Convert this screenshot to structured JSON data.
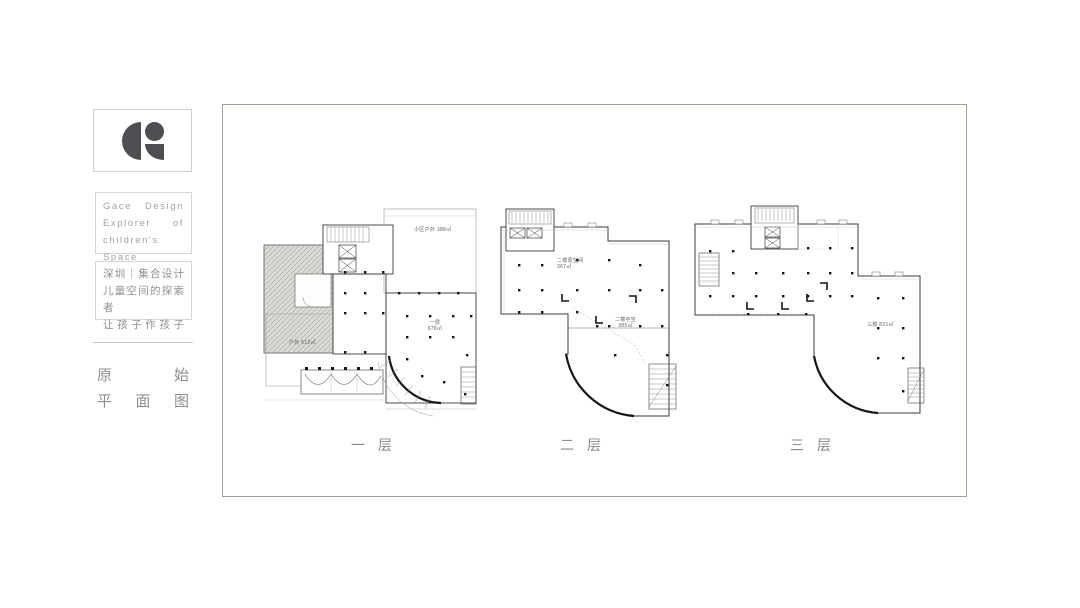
{
  "sidebar": {
    "brand_lines": [
      "Gace Design",
      "Explorer of",
      "children's Space"
    ],
    "tagline_lines": [
      "深圳｜集合设计",
      "儿童空间的探索者",
      "让孩子作孩子"
    ],
    "section_title_lines": [
      "原始",
      "平面图"
    ]
  },
  "board": {
    "plans": [
      {
        "caption": "一层",
        "labels": {
          "outdoor_upper": "小区户外 388㎡",
          "floor_name": "一层",
          "floor_area": "678㎡",
          "terrace": "户外 512㎡"
        }
      },
      {
        "caption": "二层",
        "labels": {
          "space_name": "二楼原空间",
          "space_area": "367㎡",
          "void_name": "二楼中空",
          "void_area": "385㎡"
        }
      },
      {
        "caption": "三层",
        "labels": {
          "floor_label": "三楼 831㎡"
        }
      }
    ]
  },
  "colors": {
    "logo": "#4e4e52",
    "wall_line": "#3a3a3a",
    "muted_text": "#90908d"
  }
}
